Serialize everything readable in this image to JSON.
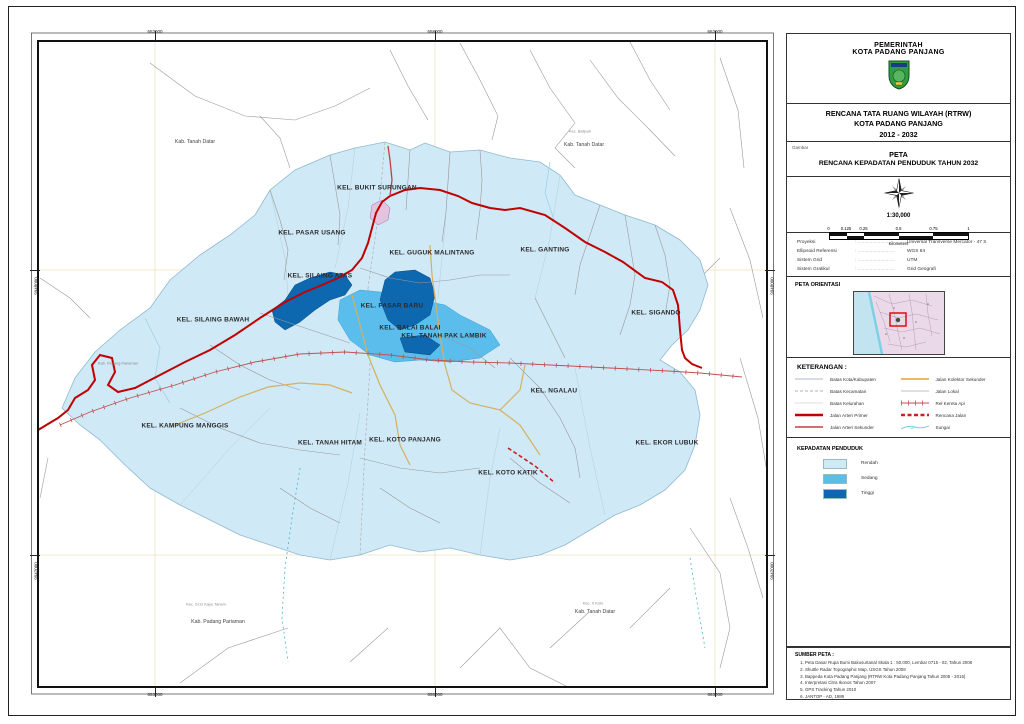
{
  "panel": {
    "header": {
      "line1": "PEMERINTAH",
      "line2": "KOTA PADANG PANJANG"
    },
    "title": {
      "line1": "RENCANA TATA RUANG WILAYAH (RTRW)",
      "line2": "KOTA PADANG PANJANG",
      "line3": "2012 - 2032"
    },
    "gambar": {
      "tag": "Gambar",
      "line1": "PETA",
      "line2": "RENCANA KEPADATAN PENDUDUK TAHUN 2032"
    },
    "scale": {
      "ratio": "1:30,000",
      "ticks": [
        "0",
        "0.125",
        "0.25",
        "0.5",
        "0.75",
        "1"
      ],
      "unit": "Kilometers"
    },
    "projection": {
      "rows": [
        {
          "label": "Proyeksi",
          "value": "Universal Transverse Mercator - 47 S"
        },
        {
          "label": "Ellipsoid Referensi",
          "value": "WGS 84"
        },
        {
          "label": "Sistem Grid",
          "value": "UTM"
        },
        {
          "label": "Sistem Gratikul",
          "value": "Grid Geografi"
        }
      ]
    },
    "orientasi": {
      "title": "PETA ORIENTASI"
    },
    "keterangan": {
      "title": "KETERANGAN :",
      "left": [
        {
          "label": "Batas Kota/Kabupaten",
          "style": "batas_kota"
        },
        {
          "label": "Batas Kecamatan",
          "style": "batas_kec"
        },
        {
          "label": "Batas Kelurahan",
          "style": "batas_kel"
        },
        {
          "label": "Jalan Arteri Primer",
          "style": "arteri_primer"
        },
        {
          "label": "Jalan Arteri Sekunder",
          "style": "arteri_sekunder"
        }
      ],
      "right": [
        {
          "label": "Jalan Kolektor Sekunder",
          "style": "kolektor"
        },
        {
          "label": "Jalan Lokal",
          "style": "lokal"
        },
        {
          "label": "Rel Kereta Api",
          "style": "rel"
        },
        {
          "label": "Rencana Jalan",
          "style": "rencana"
        },
        {
          "label": "Sungai",
          "style": "sungai"
        }
      ]
    },
    "kepadatan": {
      "title": "KEPADATAN PENDUDUK",
      "classes": [
        {
          "label": "Rendah",
          "color": "#cfe9f7"
        },
        {
          "label": "Sedang",
          "color": "#5bbdec"
        },
        {
          "label": "Tinggi",
          "color": "#0d68b0"
        }
      ]
    },
    "sumber": {
      "title": "SUMBER PETA :",
      "items": [
        "Peta Dasar Rupa Bumi Bakosurtanal Skala 1 : 50.000, Lembar 0715 - 02, Tahun 2008",
        "Shuttle Radar Topographic Map, USGS Tahun 2008",
        "Bappeda Kota Padang Panjang (RTRW Kota Padang Panjang Tahun 2005 - 2015)",
        "Interpretasi Citra Ikonos Tahun 2007",
        "GPS Tracking Tahun 2010",
        "JANTOP - AD, 1989"
      ]
    }
  },
  "map": {
    "labels": [
      {
        "text": "KEL. BUKIT SURUNGAN",
        "x": 347,
        "y": 160
      },
      {
        "text": "KEL. PASAR USANG",
        "x": 282,
        "y": 205
      },
      {
        "text": "KEL. GUGUK MALINTANG",
        "x": 402,
        "y": 225
      },
      {
        "text": "KEL. GANTING",
        "x": 515,
        "y": 222
      },
      {
        "text": "KEL. SILAING ATAS",
        "x": 290,
        "y": 248
      },
      {
        "text": "KEL. SILAING BAWAH",
        "x": 183,
        "y": 292
      },
      {
        "text": "KEL. PASAR BARU",
        "x": 362,
        "y": 278
      },
      {
        "text": "KEL. BALAI BALAI",
        "x": 380,
        "y": 300
      },
      {
        "text": "KEL. TANAH PAK LAMBIK",
        "x": 414,
        "y": 308
      },
      {
        "text": "KEL. SIGANDO",
        "x": 626,
        "y": 285
      },
      {
        "text": "KEL. NGALAU",
        "x": 524,
        "y": 363
      },
      {
        "text": "KEL. KAMPUNG MANGGIS",
        "x": 155,
        "y": 398
      },
      {
        "text": "KEL. TANAH HITAM",
        "x": 300,
        "y": 415
      },
      {
        "text": "KEL. KOTO PANJANG",
        "x": 375,
        "y": 412
      },
      {
        "text": "KEL. KOTO KATIK",
        "x": 478,
        "y": 445
      },
      {
        "text": "KEL. EKOR LUBUK",
        "x": 637,
        "y": 415
      }
    ],
    "region_labels": [
      {
        "text": "Kab. Tanah Datar",
        "x": 165,
        "y": 114,
        "kind": "kab"
      },
      {
        "text": "Kec. Batipuh",
        "x": 550,
        "y": 103,
        "kind": "kec"
      },
      {
        "text": "Kab. Tanah Datar",
        "x": 554,
        "y": 117,
        "kind": "kab"
      },
      {
        "text": "Kab. Padang Pariaman",
        "x": 88,
        "y": 335,
        "kind": "kec"
      },
      {
        "text": "Kec. 2x11 Kayu Tanam",
        "x": 176,
        "y": 576,
        "kind": "kec"
      },
      {
        "text": "Kab. Padang Pariaman",
        "x": 188,
        "y": 594,
        "kind": "kab"
      },
      {
        "text": "Kec. X Koto",
        "x": 563,
        "y": 575,
        "kind": "kec"
      },
      {
        "text": "Kab. Tanah Datar",
        "x": 565,
        "y": 584,
        "kind": "kab"
      }
    ],
    "coords": {
      "top": [
        {
          "label": "653000",
          "x": 125
        },
        {
          "label": "658000",
          "x": 405
        },
        {
          "label": "663000",
          "x": 685
        }
      ],
      "bottom": [
        {
          "label": "653000",
          "x": 125
        },
        {
          "label": "658000",
          "x": 405
        },
        {
          "label": "663000",
          "x": 685
        }
      ],
      "left": [
        {
          "label": "9948000",
          "y": 242
        },
        {
          "label": "9942000",
          "y": 527
        }
      ],
      "right": [
        {
          "label": "9948000",
          "y": 242
        },
        {
          "label": "9942000",
          "y": 527
        }
      ]
    },
    "colors": {
      "rendah": "#cfe9f7",
      "sedang": "#5bbdec",
      "tinggi": "#0d68b0",
      "jalan_arteri_primer": "#c00000",
      "rel_kereta_api": "#c05050",
      "jalan_kolektor": "#d4b15f",
      "sungai": "#7fd0e4"
    }
  }
}
